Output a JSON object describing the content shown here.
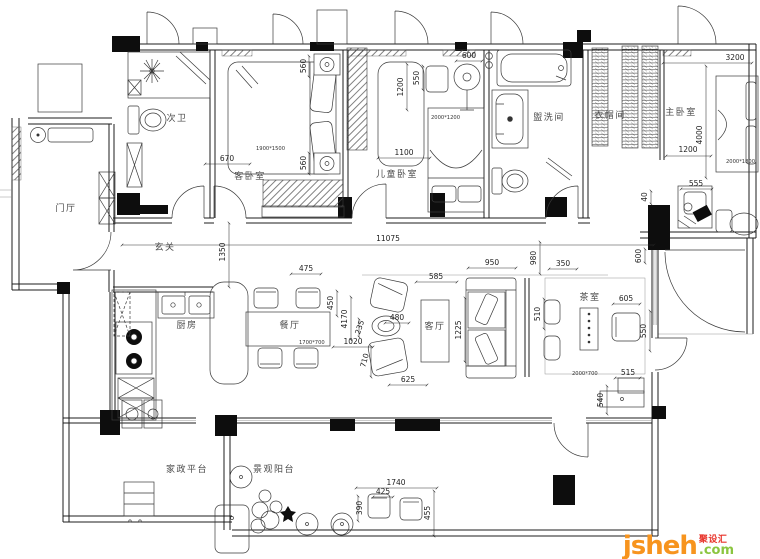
{
  "rooms": {
    "second_bath": "次卫",
    "guest_bedroom": "客卧室",
    "kids_bedroom": "儿童卧室",
    "washroom": "盥洗间",
    "cloakroom": "衣帽间",
    "master_bedroom": "主卧室",
    "entry_hall": "门厅",
    "foyer": "玄关",
    "kitchen": "厨房",
    "dining_room": "餐厅",
    "living_room": "客厅",
    "tea_room": "茶室",
    "service_deck": "家政平台",
    "view_balcony": "景观阳台"
  },
  "furniture_sizes": {
    "guest_bed": "1900*1500",
    "kids_bed": "2000*1200",
    "master_bed": "2000*1800",
    "dining_table": "1700*700",
    "tea_table": "2000*700"
  },
  "dims": {
    "d670": "670",
    "d560_top": "560",
    "d560_bottom": "560",
    "d1200_kids": "1200",
    "d550_kids": "550",
    "d600_kids": "600",
    "d1100": "1100",
    "d3200": "3200",
    "d4000": "4000",
    "d1200_master": "1200",
    "d555": "555",
    "d40": "40",
    "d11075": "11075",
    "d1350": "1350",
    "d475": "475",
    "d450": "450",
    "d4170": "4170",
    "d1020": "1020",
    "d235": "235",
    "d480": "480",
    "d585": "585",
    "d950": "950",
    "d980": "980",
    "d350": "350",
    "d1225": "1225",
    "d510": "510",
    "d710": "710",
    "d625": "625",
    "d605": "605",
    "d550_tea": "550",
    "d600_tea": "600",
    "d515": "515",
    "d540": "540",
    "d1740": "1740",
    "d425": "425",
    "d390": "390",
    "d455": "455"
  },
  "watermark": {
    "brand": "jsheh",
    "suffix": ".com",
    "cn_label": "聚设汇",
    "brand_color": "#f7941e",
    "suffix_color": "#8bc53f",
    "cn_color": "#e8332a"
  }
}
